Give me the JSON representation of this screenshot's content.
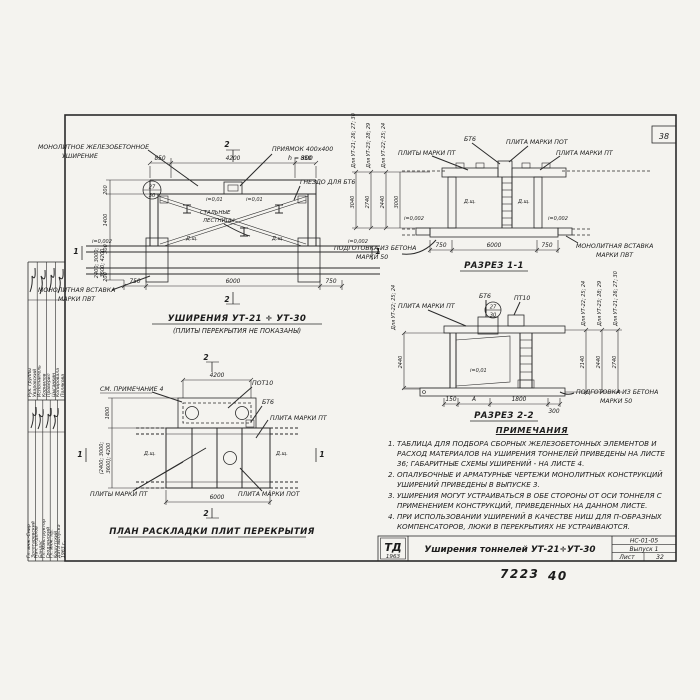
{
  "sheet": {
    "corner_number": "38",
    "handwritten1": "7223",
    "handwritten2": "40"
  },
  "titleblock": {
    "logo_top": "ТД",
    "logo_year": "1963",
    "title": "Уширения тоннелей УТ-21÷УТ-30",
    "code": "НС-01-05",
    "issue": "Выпуск 1",
    "sheet_label": "Лист",
    "sheet_number": "32"
  },
  "sidebar": {
    "upper": [
      {
        "role": "Рук. группы",
        "name": "Уваровский"
      },
      {
        "role": "Исполнитель",
        "name": "Корнилов"
      },
      {
        "role": "Проверил",
        "name": "Цыганкин"
      },
      {
        "role": "Копировала",
        "name": "Полякова"
      }
    ],
    "lower": [
      {
        "role": "Гл. инж.-Снир",
        "name": "Золотаревский"
      },
      {
        "role": "Нач. отделов",
        "name": "Бандас"
      },
      {
        "role": "Гл. конструктор",
        "name": "Гродзенский"
      },
      {
        "role": "Гл. инж. пр.",
        "name": "Кошутский"
      },
      {
        "role": "Дата выпуска",
        "name": "1963 г."
      }
    ]
  },
  "plan": {
    "caption": "УШИРЕНИЯ УТ-21 ÷ УТ-30",
    "subcaption": "(ПЛИТЫ ПЕРЕКРЫТИЯ НЕ ПОКАЗАНЫ)",
    "label_monolithic1": "МОНОЛИТНОЕ ЖЕЛЕЗОБЕТОННОЕ",
    "label_monolithic2": "УШИРЕНИЕ",
    "label_pit1": "ПРИЯМОК 400х400",
    "label_pit2": "h = 300",
    "label_socket": "ГНЕЗДО ДЛЯ БТ6",
    "label_ladders1": "СТАЛЬНЫЕ",
    "label_ladders2": "ЛЕСТНИЦЫ",
    "label_insert1": "МОНОЛИТНАЯ ВСТАВКА",
    "label_insert2": "МАРКИ ПВТ",
    "mark_top": "27",
    "mark_bottom": "30",
    "slope_left": "i=0,002",
    "slope_right": "i=0,002",
    "slope1": "i=0,01",
    "slope2": "i=0,01",
    "dsh_left": "Д.щ.",
    "dsh_right": "Д.щ.",
    "dim_top": [
      "850",
      "4200",
      "850"
    ],
    "dim_bottom": [
      "750",
      "6000",
      "750"
    ],
    "dim_left": [
      "200",
      "1400",
      "300",
      "2400; 3000;",
      "3600; 4200",
      "200"
    ],
    "sec1": "1",
    "sec2": "2"
  },
  "section11": {
    "caption": "РАЗРЕЗ 1-1",
    "label_pt_left": "ПЛИТЫ МАРКИ ПТ",
    "label_bt6": "БТ6",
    "label_pot": "ПЛИТА МАРКИ ПОТ",
    "label_pt_right": "ПЛИТА МАРКИ ПТ",
    "label_insert1": "МОНОЛИТНАЯ ВСТАВКА",
    "label_insert2": "МАРКИ ПВТ",
    "label_base1": "ПОДГОТОВКА ИЗ БЕТОНА",
    "label_base2": "МАРКИ 50",
    "dsh": "Д.щ.",
    "slope": "i=0,002",
    "left_dim": "3000",
    "dim_bottom": [
      "750",
      "6000",
      "750"
    ],
    "heights": [
      {
        "group": "Для УТ-21; 26; 27; 30",
        "value": "3040"
      },
      {
        "group": "Для УТ-23; 28; 29",
        "value": "2740"
      },
      {
        "group": "Для УТ-22; 25; 24",
        "value": "2440"
      }
    ]
  },
  "section22": {
    "caption": "РАЗРЕЗ 2-2",
    "label_pt": "ПЛИТА МАРКИ ПТ",
    "label_bt6": "БТ6",
    "label_pt10": "ПТ10",
    "mark_top": "27",
    "mark_bottom": "30",
    "slope": "i=0,01",
    "label_base1": "ПОДГОТОВКА ИЗ БЕТОНА",
    "label_base2": "МАРКИ 50",
    "left_group": "Для УТ-22; 25; 24",
    "left_dim": "2440",
    "dim_bottom": [
      "150",
      "А",
      "1800",
      "300"
    ],
    "heights": [
      {
        "group": "Для УТ-22; 25; 24",
        "value": "2140"
      },
      {
        "group": "Для УТ-23; 28; 29",
        "value": "2440"
      },
      {
        "group": "Для УТ-21; 26; 27; 30",
        "value": "2740"
      }
    ]
  },
  "notes": {
    "heading": "ПРИМЕЧАНИЯ",
    "items": [
      "1. ТАБЛИЦА ДЛЯ ПОДБОРА СБОРНЫХ ЖЕЛЕЗОБЕТОННЫХ ЭЛЕМЕНТОВ И РАСХОД МАТЕРИАЛОВ НА УШИРЕНИЯ ТОННЕЛЕЙ ПРИВЕДЕНЫ НА ЛИСТЕ 36; ГАБАРИТНЫЕ СХЕМЫ УШИРЕНИЙ - НА ЛИСТЕ 4.",
      "2. ОПАЛУБОЧНЫЕ И АРМАТУРНЫЕ ЧЕРТЕЖИ МОНОЛИТНЫХ КОНСТРУКЦИЙ УШИРЕНИЙ ПРИВЕДЕНЫ В ВЫПУСКЕ 3.",
      "3. УШИРЕНИЯ МОГУТ УСТРАИВАТЬСЯ В ОБЕ СТОРОНЫ ОТ ОСИ ТОННЕЛЯ С ПРИМЕНЕНИЕМ КОНСТРУКЦИЙ, ПРИВЕДЕННЫХ НА ДАННОМ ЛИСТЕ.",
      "4. ПРИ ИСПОЛЬЗОВАНИИ УШИРЕНИЙ В КАЧЕСТВЕ НИШ ДЛЯ П-ОБРАЗНЫХ КОМПЕНСАТОРОВ, ЛЮКИ В ПЕРЕКРЫТИЯХ НЕ УСТРАИВАЮТСЯ."
    ]
  },
  "slabplan": {
    "caption": "ПЛАН РАСКЛАДКИ ПЛИТ ПЕРЕКРЫТИЯ",
    "label_note": "СМ. ПРИМЕЧАНИЕ 4",
    "label_pot10": "ПОТ10",
    "label_bt6": "БТ6",
    "label_pt_right": "ПЛИТА МАРКИ ПТ",
    "label_pt_bottom": "ПЛИТЫ МАРКИ ПТ",
    "label_pot_bottom": "ПЛИТА МАРКИ ПОТ",
    "dsh_left": "Д.щ.",
    "dsh_right": "Д.щ.",
    "dim_top": "4200",
    "dim_bottom": "6000",
    "dim_left1": "1800",
    "dim_left2": "(2400; 3000;",
    "dim_left3": "3600); 4200",
    "sec1": "1",
    "sec2": "2"
  }
}
